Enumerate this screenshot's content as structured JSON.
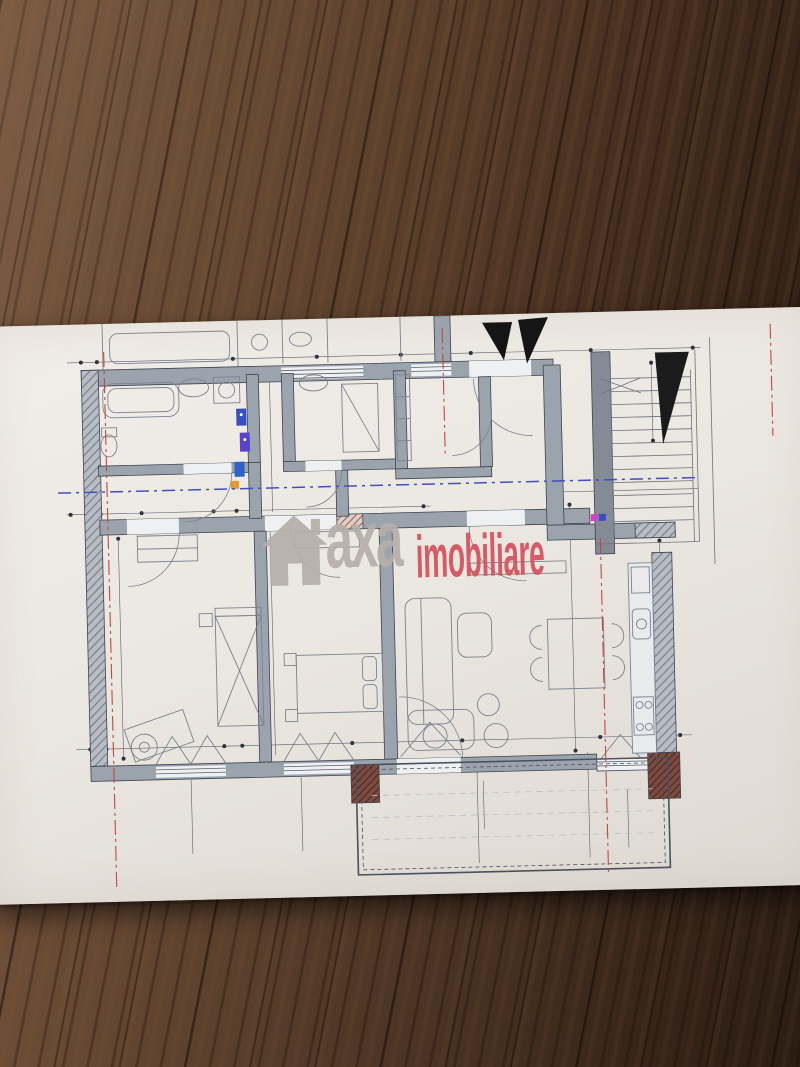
{
  "watermark": {
    "brand": "axa",
    "suffix": "imobiliare"
  },
  "rooms": [
    {
      "id": "2.07.5",
      "name": "Baie",
      "floor": "greso-granit",
      "area": "A: 6.4 m²",
      "x": 215,
      "y": 108,
      "fs": 13
    },
    {
      "id": "2.07.6",
      "name": "Baie",
      "floor": "F: greso-granit",
      "area": "A: 4.0 m²",
      "x": 348,
      "y": 97,
      "fs": 12
    },
    {
      "id": "2.07.7",
      "name": "Dressing",
      "floor": "F: parchet",
      "area": "A: 3.2 m²",
      "x": 458,
      "y": 102,
      "fs": 12.5
    },
    {
      "id": "2.07.1",
      "name": "Hol",
      "floor": "F: parchet",
      "area": "A: 3.1 m²",
      "x": 538,
      "y": 127,
      "fs": 12.5
    },
    {
      "id": "2.07.8",
      "name": "Hol",
      "floor": "F: parchet",
      "area": "A: 4.4 m²",
      "x": 338,
      "y": 164,
      "fs": 12
    },
    {
      "id": "2.07.2",
      "name": "Camera de zi+Bucatarie",
      "floor": "F: parchet",
      "area": "A: 36.6 m²",
      "x": 530,
      "y": 288,
      "fs": 14
    },
    {
      "id": "2.07.4",
      "name": "Dormitor",
      "floor": "F: parchet",
      "area": "A: 18.9 m²",
      "x": 196,
      "y": 352,
      "fs": 14
    },
    {
      "id": "2.07.3",
      "name": "Dormitor",
      "floor": "F: parchet",
      "area": "A: 16.2 m²",
      "x": 337,
      "y": 372,
      "fs": 14
    },
    {
      "id": "2.07.8",
      "name": "Terasa",
      "floor": "F: greso-granit",
      "area": "A: 6.9 m²",
      "x": 424,
      "y": 506,
      "fs": 13
    }
  ],
  "dims": [
    {
      "t": "0.15",
      "x": 92,
      "y": 40,
      "fs": 9
    },
    {
      "t": "0.30",
      "x": 133,
      "y": 40
    },
    {
      "t": "3.00",
      "x": 193,
      "y": 41
    },
    {
      "t": "0.12",
      "x": 250,
      "y": 39
    },
    {
      "t": "1.76",
      "x": 305,
      "y": 37
    },
    {
      "t": "0.12",
      "x": 334,
      "y": 36
    },
    {
      "t": "1.62",
      "x": 387,
      "y": 35
    },
    {
      "t": "0.12",
      "x": 419,
      "y": 33
    },
    {
      "t": "1.45",
      "x": 462,
      "y": 33
    },
    {
      "t": "2.10",
      "x": 482,
      "y": 19,
      "fs": 8
    },
    {
      "t": "0.30",
      "x": 510,
      "y": 30
    },
    {
      "t": "2.26",
      "x": 575,
      "y": 28
    },
    {
      "t": "1.20",
      "x": 641,
      "y": 27
    },
    {
      "t": "0.96",
      "x": 690,
      "y": 26
    },
    {
      "t": "A: 5.7 m²",
      "x": 178,
      "y": 26,
      "fs": 12,
      "c": "#6a7078"
    },
    {
      "t": "A: 3.1 m²",
      "x": 318,
      "y": 18,
      "fs": 11,
      "c": "#6a7078"
    },
    {
      "t": "A: 2.7 m²",
      "x": 400,
      "y": 21,
      "fs": 11,
      "c": "#6a7078"
    },
    {
      "t": "3.23",
      "x": 111,
      "y": 143,
      "r": -90
    },
    {
      "t": "0.30",
      "x": 95,
      "y": 191
    },
    {
      "t": "1.60",
      "x": 161,
      "y": 190
    },
    {
      "t": "0.12",
      "x": 192,
      "y": 188
    },
    {
      "t": "1.28",
      "x": 232,
      "y": 188
    },
    {
      "t": "0.12",
      "x": 266,
      "y": 187
    },
    {
      "t": "7.28",
      "x": 433,
      "y": 186
    },
    {
      "t": "5.63",
      "x": 137,
      "y": 351,
      "r": -90
    },
    {
      "t": "5.73",
      "x": 287,
      "y": 352,
      "r": -90
    },
    {
      "t": "0.30",
      "x": 282,
      "y": 62,
      "r": -90,
      "fs": 8.5
    },
    {
      "t": "1.53",
      "x": 284,
      "y": 96,
      "r": -90,
      "fs": 8.5
    },
    {
      "t": "0.12",
      "x": 273,
      "y": 140,
      "r": -90,
      "fs": 8.5
    },
    {
      "t": "1.48",
      "x": 291,
      "y": 171,
      "r": -90,
      "fs": 8.5
    },
    {
      "t": "0.12",
      "x": 287,
      "y": 226,
      "r": -90,
      "fs": 8.5
    },
    {
      "t": "1.00",
      "x": 528,
      "y": 84,
      "r": -90,
      "fs": 8
    },
    {
      "t": "2.10",
      "x": 541,
      "y": 84,
      "r": -90,
      "fs": 8
    },
    {
      "t": "0.30",
      "x": 577,
      "y": 71,
      "r": -90,
      "fs": 8.5
    },
    {
      "t": "w",
      "x": 414,
      "y": 112,
      "fs": 8,
      "c": "#6a7078"
    },
    {
      "t": "4.80",
      "x": 665,
      "y": 82,
      "r": -90
    },
    {
      "t": "70/1",
      "x": 694,
      "y": 94,
      "fs": 7.5,
      "c": "#6a7078"
    },
    {
      "t": "Mana curenta",
      "x": 668,
      "y": 146,
      "fs": 7.5,
      "box": true,
      "n": "handrail-label"
    },
    {
      "t": "0.35",
      "x": 580,
      "y": 179
    },
    {
      "t": "3.30",
      "x": 697,
      "y": 177
    },
    {
      "t": "8.58",
      "x": 585,
      "y": 255,
      "r": -90
    },
    {
      "t": "0.55",
      "x": 668,
      "y": 227,
      "r": -90,
      "fs": 8.5
    },
    {
      "t": "5.03",
      "x": 671,
      "y": 337,
      "r": -90
    },
    {
      "t": "0.30",
      "x": 670,
      "y": 421,
      "r": -90,
      "fs": 8.5
    },
    {
      "t": "0.30",
      "x": 689,
      "y": 421,
      "fs": 8.5
    },
    {
      "t": "0.15",
      "x": 94,
      "y": 422,
      "fs": 9
    },
    {
      "t": "0.30",
      "x": 133,
      "y": 427
    },
    {
      "t": "3.00",
      "x": 190,
      "y": 424
    },
    {
      "t": "0.12",
      "x": 249,
      "y": 423
    },
    {
      "t": "3.00",
      "x": 335,
      "y": 422
    },
    {
      "t": "0.12",
      "x": 394,
      "y": 421
    },
    {
      "t": "Hp=0.00",
      "x": 203,
      "y": 474,
      "fs": 9,
      "n": "level-label"
    },
    {
      "t": "Hp=0.00",
      "x": 310,
      "y": 474,
      "fs": 9,
      "n": "level-label"
    },
    {
      "t": "Hp=0.00",
      "x": 487,
      "y": 433,
      "fs": 9,
      "n": "level-label"
    },
    {
      "t": "Hp=0.00",
      "x": 629,
      "y": 452,
      "fs": 9,
      "n": "level-label"
    },
    {
      "t": "0.47",
      "x": 98,
      "y": 491,
      "r": -90,
      "fs": 8.5
    },
    {
      "t": "0.47",
      "x": 283,
      "y": 490,
      "r": -90,
      "fs": 8.5
    },
    {
      "t": "1.60",
      "x": 191,
      "y": 517,
      "r": -90,
      "fs": 8.5
    },
    {
      "t": "2.40",
      "x": 205,
      "y": 519,
      "r": -90,
      "fs": 8.5
    },
    {
      "t": "1.60",
      "x": 301,
      "y": 518,
      "r": -90,
      "fs": 8.5
    },
    {
      "t": "2.40",
      "x": 316,
      "y": 520,
      "r": -90,
      "fs": 8.5
    },
    {
      "t": "3.00",
      "x": 478,
      "y": 483,
      "r": -90,
      "fs": 8.5
    },
    {
      "t": "2.40",
      "x": 491,
      "y": 485,
      "r": -90,
      "fs": 8.5
    },
    {
      "t": "0.30",
      "x": 538,
      "y": 428,
      "r": -90,
      "fs": 8.5
    },
    {
      "t": "0.15",
      "x": 543,
      "y": 473,
      "r": -90,
      "fs": 8.5
    },
    {
      "t": "1.95",
      "x": 542,
      "y": 503,
      "r": -90,
      "fs": 8.5
    },
    {
      "t": "4.10",
      "x": 470,
      "y": 535,
      "fs": 10
    },
    {
      "t": "0.30",
      "x": 589,
      "y": 447,
      "r": -90,
      "fs": 8.5
    },
    {
      "t": "0.30",
      "x": 579,
      "y": 482,
      "r": -90,
      "fs": 8.5
    },
    {
      "t": "0.10",
      "x": 591,
      "y": 507,
      "r": -90,
      "fs": 8.5
    },
    {
      "t": "1.20",
      "x": 581,
      "y": 527,
      "r": -90,
      "fs": 8.5
    },
    {
      "t": "0.70",
      "x": 624,
      "y": 514,
      "r": -90,
      "fs": 8.5
    },
    {
      "t": "2.40",
      "x": 639,
      "y": 516,
      "r": -90,
      "fs": 8.5
    },
    {
      "t": "BALUSTRADA METALICA",
      "x": 390,
      "y": 567,
      "fs": 9,
      "c": "#878d95",
      "ls": 1.5,
      "n": "balustrade-label"
    }
  ],
  "markers": [
    {
      "t": "UF1",
      "x": 200,
      "y": 550,
      "d": 24
    },
    {
      "t": "UF1",
      "x": 310,
      "y": 550,
      "d": 24
    },
    {
      "t": "UF4",
      "x": 490,
      "y": 529,
      "d": 24
    },
    {
      "t": "UF5",
      "x": 634,
      "y": 551,
      "d": 24
    },
    {
      "t": "U2",
      "x": 542,
      "y": 90,
      "d": 14
    }
  ]
}
